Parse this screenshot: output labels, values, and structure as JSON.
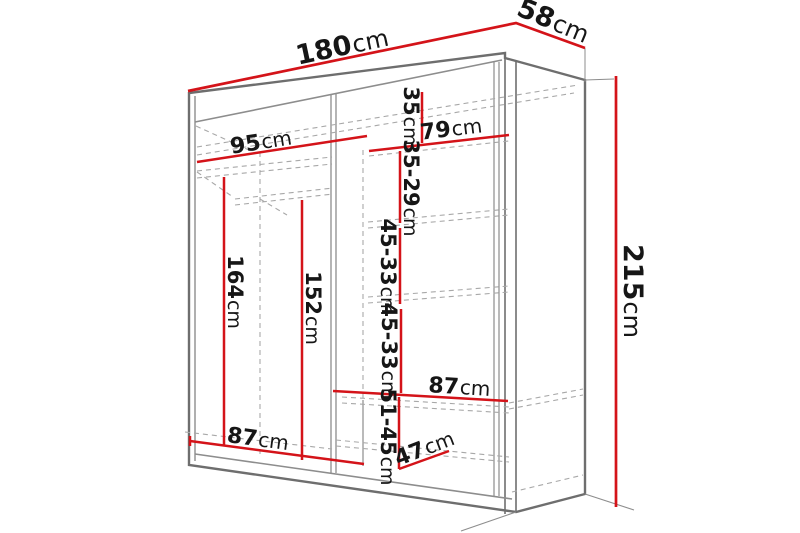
{
  "meta": {
    "type": "furniture-dimension-diagram",
    "subject": "wardrobe interior with shelves and hanging sections",
    "unit": "cm"
  },
  "colors": {
    "dimension_line": "#d41319",
    "outline": "#6e6e6e",
    "inner_line": "#8d8d8d",
    "hidden_line": "#a8a8a8",
    "label": "#161616",
    "background": "#ffffff"
  },
  "dimensions": {
    "width": {
      "value": "180",
      "unit": "cm"
    },
    "depth": {
      "value": "58",
      "unit": "cm"
    },
    "height": {
      "value": "215",
      "unit": "cm"
    },
    "left_section_width": {
      "value": "95",
      "unit": "cm"
    },
    "right_section_width": {
      "value": "79",
      "unit": "cm"
    },
    "top_shelf_gap": {
      "value": "35",
      "unit": "cm"
    },
    "shelf_gap_2": {
      "value": "35-29",
      "unit": "cm"
    },
    "shelf_gap_3": {
      "value": "45-33",
      "unit": "cm"
    },
    "shelf_gap_4": {
      "value": "45-33",
      "unit": "cm"
    },
    "hanging_height_left": {
      "value": "164",
      "unit": "cm"
    },
    "hanging_height_right": {
      "value": "152",
      "unit": "cm"
    },
    "shelf_width": {
      "value": "87",
      "unit": "cm"
    },
    "bottom_section_width": {
      "value": "87",
      "unit": "cm"
    },
    "bottom_shelf_gap": {
      "value": "51-45",
      "unit": "cm"
    },
    "bottom_shelf_depth": {
      "value": "47",
      "unit": "cm"
    }
  }
}
